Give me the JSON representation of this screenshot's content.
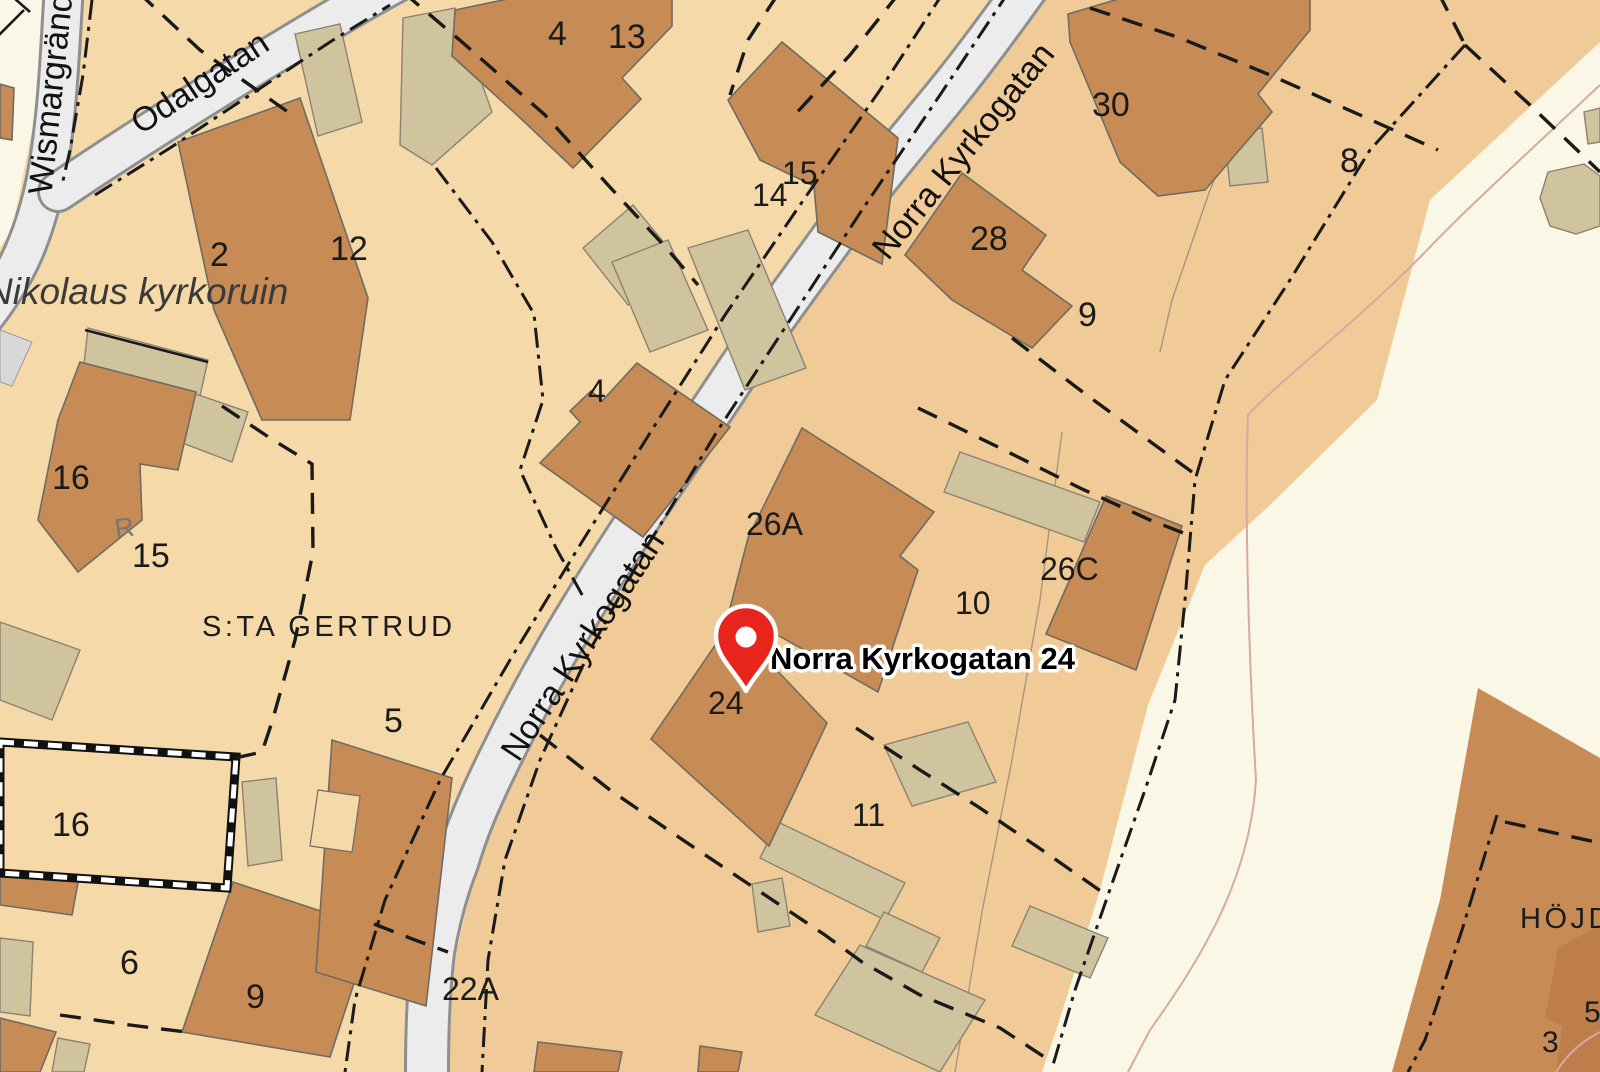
{
  "map": {
    "marker": {
      "label": "Norra Kyrkogatan 24"
    },
    "streets": [
      {
        "id": "wismargrand",
        "name": "Wismargränd"
      },
      {
        "id": "odalgatan",
        "name": "Odalgatan"
      },
      {
        "id": "norra-kyrkogatan-upper",
        "name": "Norra Kyrkogatan"
      },
      {
        "id": "norra-kyrkogatan-lower",
        "name": "Norra Kyrkogatan"
      }
    ],
    "places": [
      {
        "id": "kyrkoruin",
        "name": "Nikolaus kyrkoruin"
      },
      {
        "id": "sta-gertrud",
        "name": "S:TA GERTRUD"
      },
      {
        "id": "hojden",
        "name": "HÖJDE"
      }
    ],
    "symbols": [
      {
        "id": "ruin-r",
        "text": "R"
      }
    ],
    "numbers": [
      {
        "id": "b4-top",
        "text": "4"
      },
      {
        "id": "p13",
        "text": "13"
      },
      {
        "id": "b14",
        "text": "14"
      },
      {
        "id": "b15-top",
        "text": "15"
      },
      {
        "id": "b30",
        "text": "30"
      },
      {
        "id": "p8",
        "text": "8"
      },
      {
        "id": "b28",
        "text": "28"
      },
      {
        "id": "p9",
        "text": "9"
      },
      {
        "id": "b2",
        "text": "2"
      },
      {
        "id": "p12",
        "text": "12"
      },
      {
        "id": "b16-mid",
        "text": "16"
      },
      {
        "id": "p15",
        "text": "15"
      },
      {
        "id": "b4-center",
        "text": "4"
      },
      {
        "id": "b26a",
        "text": "26A"
      },
      {
        "id": "b26c",
        "text": "26C"
      },
      {
        "id": "p10",
        "text": "10"
      },
      {
        "id": "b24",
        "text": "24"
      },
      {
        "id": "p5",
        "text": "5"
      },
      {
        "id": "p16-wall",
        "text": "16"
      },
      {
        "id": "p6",
        "text": "6"
      },
      {
        "id": "b9-bottom",
        "text": "9"
      },
      {
        "id": "b22a",
        "text": "22A"
      },
      {
        "id": "p11",
        "text": "11"
      },
      {
        "id": "p3",
        "text": "3"
      },
      {
        "id": "p5-edge",
        "text": "5"
      }
    ],
    "colors": {
      "bg": "#F6D9A9",
      "bgEast": "#F0CB97",
      "paper": "#FAF7E6",
      "road": "#ECECEC",
      "roadEdge": "#8F8F8F",
      "building": "#C78B55",
      "buildingDark": "#BD7E4B",
      "outbuilding": "#CFC49D",
      "outline": "#6F6B62",
      "boundary": "#1A1A1A",
      "path": "#D9A9A0",
      "parcelLine": "#A8947E",
      "pin": "#E8251D",
      "label": "#1B1B1B"
    }
  }
}
